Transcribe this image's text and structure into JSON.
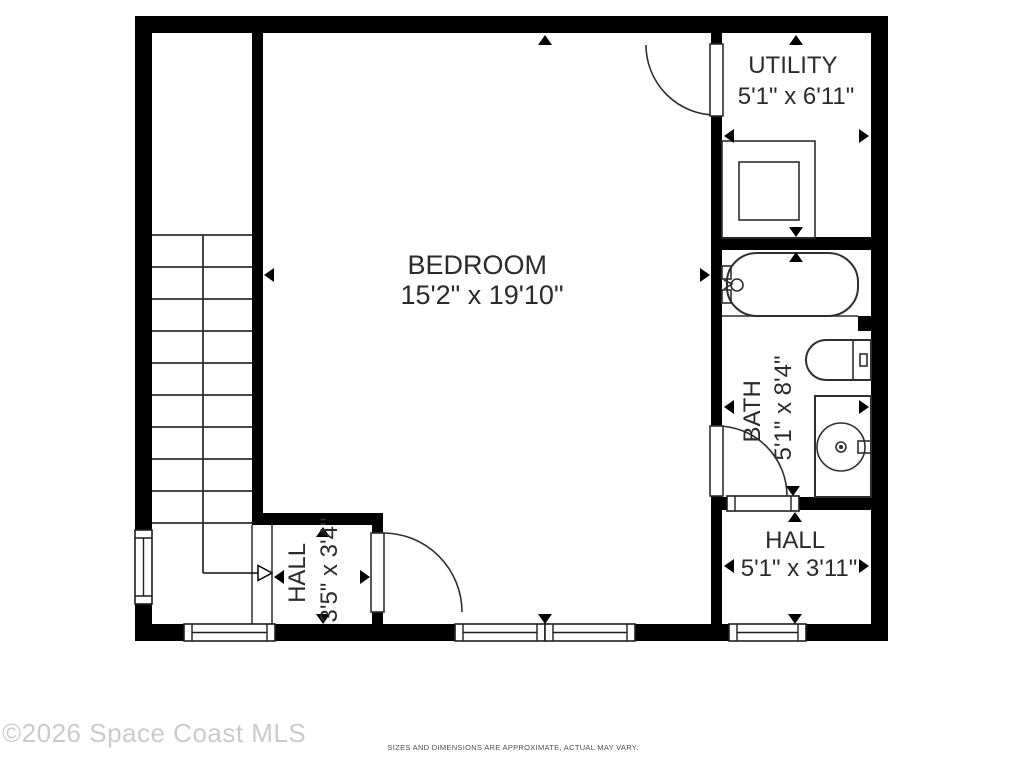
{
  "rooms": {
    "bedroom": {
      "name": "BEDROOM",
      "dims": "15'2\" x 19'10\""
    },
    "utility": {
      "name": "UTILITY",
      "dims": "5'1\" x 6'11\""
    },
    "bath": {
      "name": "BATH",
      "dims": "5'1\" x 8'4\""
    },
    "hall_right": {
      "name": "HALL",
      "dims": "5'1\" x 3'11\""
    },
    "hall_left": {
      "name": "HALL",
      "dims": "3'5\" x 3'4\""
    }
  },
  "footer": {
    "watermark": "©2026 Space Coast MLS",
    "disclaimer": "SIZES AND DIMENSIONS ARE APPROXIMATE, ACTUAL MAY VARY."
  },
  "colors": {
    "wall": "#000000",
    "fixture_line": "#2f2f2f",
    "label_text": "#2b2b2b",
    "watermark_text": "#cbcbcb",
    "disclaimer_text": "#4f4f4f"
  }
}
